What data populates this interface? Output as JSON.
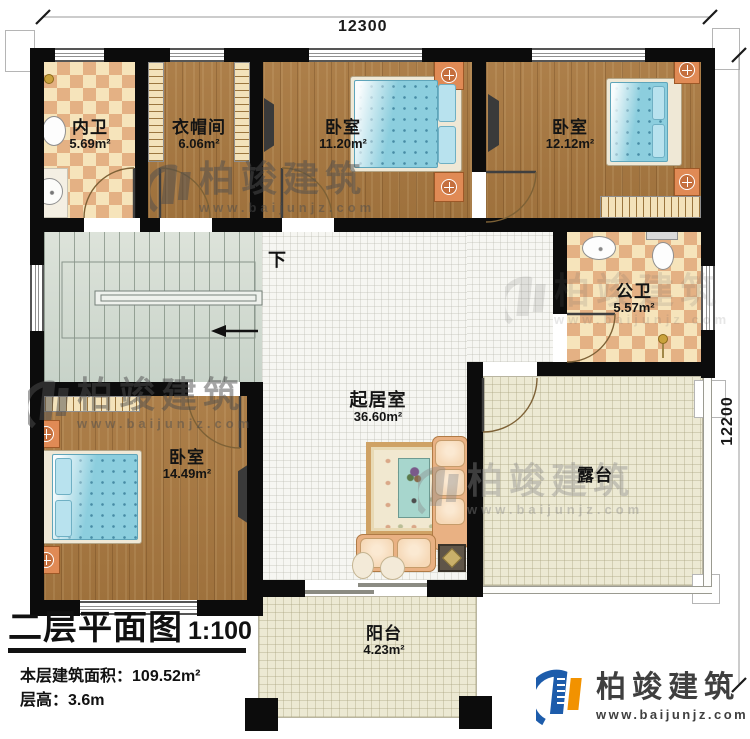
{
  "title_block": {
    "title": "二层平面图",
    "scale": "1:100",
    "area_label": "本层建筑面积：",
    "area_value": "109.52m²",
    "height_label": "层高：",
    "height_value": "3.6m"
  },
  "dimensions": {
    "width_mm": "12300",
    "depth_mm": "12200"
  },
  "rooms": {
    "inner_bath": {
      "name": "内卫",
      "area": "5.69m²"
    },
    "cloakroom": {
      "name": "衣帽间",
      "area": "6.06m²"
    },
    "bedroom_top_mid": {
      "name": "卧室",
      "area": "11.20m²"
    },
    "bedroom_top_right": {
      "name": "卧室",
      "area": "12.12m²"
    },
    "public_bath": {
      "name": "公卫",
      "area": "5.57m²"
    },
    "living": {
      "name": "起居室",
      "area": "36.60m²"
    },
    "bedroom_left": {
      "name": "卧室",
      "area": "14.49m²"
    },
    "terrace": {
      "name": "露台"
    },
    "balcony": {
      "name": "阳台",
      "area": "4.23m²"
    }
  },
  "stairs": {
    "direction_label": "下"
  },
  "branding": {
    "company": "柏竣建筑",
    "website": "www.baijunjz.com"
  },
  "colors": {
    "wall": "#0c0c0c",
    "wood_floor": "#a87840",
    "bath_tile_light": "#f6e4bb",
    "bath_tile_dark": "#e4b184",
    "stair_floor": "#d3dcd3",
    "terrace_tile": "#ece9d3",
    "bed_blue": "#8ccede",
    "logo_blue": "#1d5cab",
    "logo_orange": "#f29200",
    "watermark_gray": "#5a5a5a"
  }
}
